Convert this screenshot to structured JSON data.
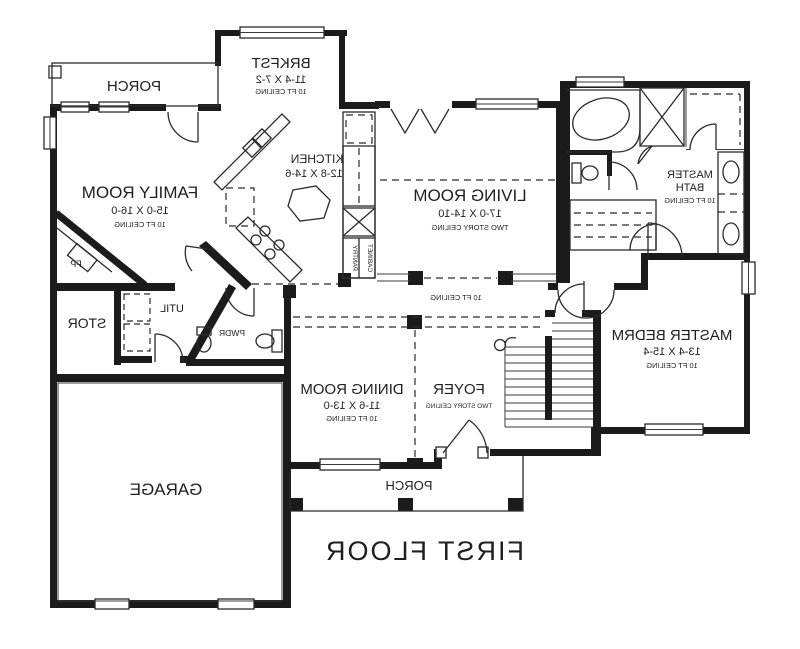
{
  "title": "FIRST FLOOR",
  "colors": {
    "wall": "#1b1b1b",
    "background": "#ffffff",
    "line": "#2b2b2b"
  },
  "rooms": {
    "porch_top": {
      "name": "PORCH"
    },
    "brkfst": {
      "name": "BRKFST",
      "dims": "11-4 X 7-2",
      "ceiling": "10 FT CEILING"
    },
    "family": {
      "name": "FAMILY ROOM",
      "dims": "15-0 X 16-0",
      "ceiling": "10 FT CEILING"
    },
    "kitchen": {
      "name": "KITCHEN",
      "dims": "12-8 X 14-6"
    },
    "living": {
      "name": "LIVING ROOM",
      "dims": "17-0 X 14-10",
      "ceiling": "TWO STORY CEILING"
    },
    "master_bath": {
      "name_line1": "MASTER",
      "name_line2": "BATH",
      "ceiling": "10 FT CEILING"
    },
    "master_bedrm": {
      "name": "MASTER BEDRM",
      "dims": "13-4 X 15-4",
      "ceiling": "10 FT CEILING"
    },
    "hall": {
      "ceiling": "10 FT CEILING"
    },
    "dining": {
      "name": "DINING ROOM",
      "dims": "11-6 X 13-0",
      "ceiling": "10 FT CEILING"
    },
    "foyer": {
      "name": "FOYER",
      "ceiling": "TWO STORY CEILING"
    },
    "stor": {
      "name": "STOR"
    },
    "util": {
      "name": "UTIL"
    },
    "pwdr": {
      "name": "PWDR"
    },
    "garage": {
      "name": "GARAGE"
    },
    "porch_bottom": {
      "name": "PORCH"
    }
  },
  "labels": {
    "fireplace": "FP",
    "pantry": "PANTRY",
    "cabinet": "CABINET"
  }
}
